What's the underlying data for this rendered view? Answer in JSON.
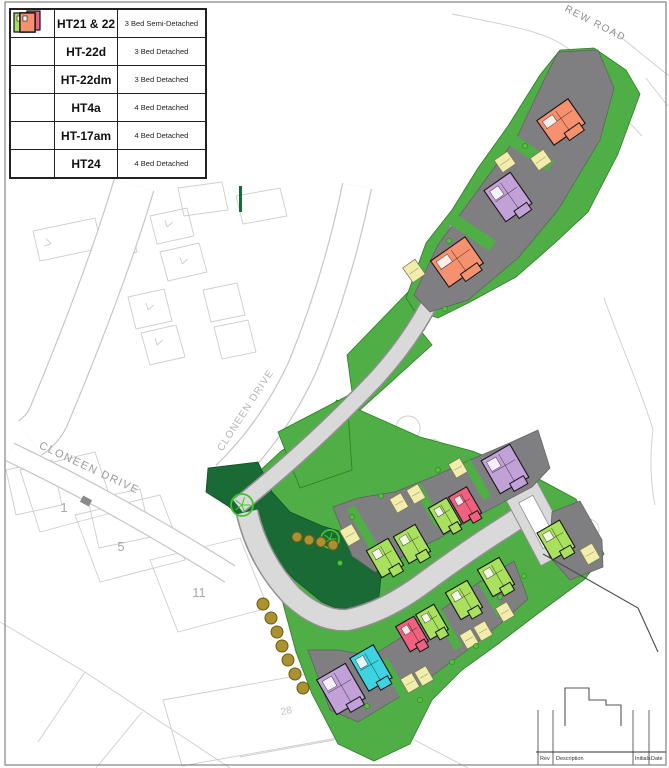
{
  "legend": {
    "rows": [
      {
        "colors": [
          "green",
          "pink"
        ],
        "name": "HT21 & 22",
        "desc": "3 Bed Semi-Detached"
      },
      {
        "colors": [
          "green"
        ],
        "name": "HT-22d",
        "desc": "3 Bed Detached"
      },
      {
        "colors": [
          "green"
        ],
        "name": "HT-22dm",
        "desc": "3 Bed Detached"
      },
      {
        "colors": [
          "cyan"
        ],
        "name": "HT4a",
        "desc": "4 Bed Detached"
      },
      {
        "colors": [
          "purple"
        ],
        "name": "HT-17am",
        "desc": "4 Bed Detached"
      },
      {
        "colors": [
          "orange"
        ],
        "name": "HT24",
        "desc": "4 Bed Detached"
      }
    ]
  },
  "map": {
    "palette": {
      "parcel": "#4fae45",
      "dark": "#1a6a36",
      "road": "#d9d9d9",
      "roadCase": "#8f8f8f",
      "whiteCase": "#c6c6c6",
      "drive": "#7f7f81",
      "garage": "#f2edaa",
      "faint": "#cdcdcd",
      "bush": "#ab9230",
      "tree": "#3fc52f",
      "green": "#a9e15e",
      "pink": "#f0617f",
      "purple": "#c2a0d8",
      "cyan": "#3dd3e1",
      "orange": "#f5916e"
    },
    "faint": {
      "quads": [
        "178,188 222,182 228,210 184,216",
        "150,216 187,208 194,236 157,244",
        "160,252 199,243 207,272 168,281",
        "128,297 164,289 172,321 136,329",
        "141,333 176,325 185,357 150,365",
        "103,233 131,227 137,252 109,258",
        "33,231 95,218 102,248 40,261",
        "236,196 280,188 287,216 243,224",
        "203,290 237,283 245,315 211,322",
        "214,327 248,320 256,352 222,359",
        "6,470 52,460 62,505 16,515",
        "88,500 140,489 151,537 99,548",
        "20,470 95,452 115,512 40,532",
        "75,515 160,495 185,560 100,582",
        "150,560 240,538 268,608 178,632",
        "163,700 318,672 338,738 182,766",
        "375,327 413,318 420,352 382,361"
      ],
      "lines": [
        "M0,622 L85,672 L230,768",
        "M85,672 L38,742",
        "M142,712 L96,768",
        "M240,757 L334,740",
        "M338,700 L468,768",
        "M604,298 C622,348 641,390 653,430",
        "M653,430 Q648,470 655,505",
        "M598,90 L642,136",
        "M646,78 Q659,95 668,106",
        "M452,14 C512,26 548,32 570,50 C586,64 596,84 604,106 L612,132",
        "M612,30 L669,76"
      ],
      "chevrons": [
        [
          168,
          224,
          15
        ],
        [
          183,
          261,
          15
        ],
        [
          149,
          307,
          15
        ],
        [
          158,
          342,
          15
        ],
        [
          48,
          243,
          -75
        ]
      ],
      "circles": [
        [
          425,
          556,
          14
        ],
        [
          451,
          534,
          11
        ],
        [
          408,
          428,
          12
        ],
        [
          588,
          530,
          11
        ],
        [
          432,
          448,
          9
        ]
      ]
    },
    "whiteRoads": [
      {
        "d": "M134,185 C114,252 84,332 48,418 Q42,430 30,438",
        "w": 40
      },
      {
        "d": "M10,452 Q115,502 230,574",
        "w": 18
      },
      {
        "d": "M357,186 Q338,280 302,368 Q272,432 226,476",
        "w": 28
      }
    ],
    "greens": [
      "337,400 420,437 472,451 524,471 576,499 604,554 585,579 540,612 498,644 462,670 432,700 410,744 374,761 338,744 312,694 296,652 282,600 258,545 238,505 250,480 280,452 310,430",
      "278,432 347,396 352,470 300,488",
      "347,355 412,288 420,330 352,392",
      "345,398 420,330 432,345 360,410",
      "406,298 426,243 452,210 478,168 508,126 540,75 560,50 594,48 626,70 640,94 618,154 588,212 556,242 516,277 470,302 438,318 414,310"
    ],
    "darkGreen": "208,468 258,462 272,492 290,512 322,526 356,536 384,547 378,606 352,615 322,602 295,580 268,552 247,522 228,506 206,492",
    "darkSliver": [
      239,
      186,
      3,
      26
    ],
    "greyRoads": [
      {
        "d": "M247,512 Q258,560 292,596 Q320,622 348,620 Q385,612 425,582 Q470,549 505,527 L526,513",
        "w": 20
      },
      {
        "d": "M238,506 Q310,448 370,385 Q420,333 445,270 Q455,240 460,220",
        "w": 15
      }
    ],
    "hammerhead": {
      "outer": [
        538,
        522,
        36,
        80,
        -28
      ],
      "island": [
        538,
        522,
        16,
        52,
        -28
      ]
    },
    "drives": [
      "558,52 598,50 614,88 600,140 558,210 518,258 468,300 430,312 414,295 438,245 478,190 518,135 543,82",
      "333,507 352,556 375,572 415,550 440,538 470,520 500,504 532,487 550,468 538,430 505,445 470,460 430,478 395,492 358,498",
      "308,650 330,710 358,722 396,699 432,676 466,651 500,624 528,599 514,561 478,583 444,608 408,633 372,656 338,650",
      "552,512 580,501 602,540 603,567 570,580 549,556"
    ],
    "gaps": [
      [
        362,
        527,
        9,
        46,
        -30
      ],
      [
        428,
        505,
        9,
        46,
        -30
      ],
      [
        477,
        480,
        9,
        42,
        -30
      ],
      [
        394,
        678,
        9,
        42,
        -30
      ],
      [
        448,
        630,
        9,
        42,
        -30
      ],
      [
        492,
        598,
        9,
        38,
        -30
      ],
      [
        530,
        152,
        50,
        12,
        34
      ],
      [
        472,
        232,
        50,
        12,
        34
      ]
    ],
    "junctionPad": [
      86,
      501,
      10,
      7,
      28
    ],
    "garages": [
      [
        505,
        162,
        16,
        15,
        -35
      ],
      [
        541,
        160,
        16,
        15,
        -35
      ],
      [
        414,
        271,
        15,
        18,
        -35
      ],
      [
        350,
        535,
        14,
        18,
        -30
      ],
      [
        399,
        503,
        13,
        16,
        -30
      ],
      [
        416,
        494,
        13,
        16,
        -30
      ],
      [
        458,
        468,
        13,
        16,
        -30
      ],
      [
        590,
        554,
        14,
        17,
        -30
      ],
      [
        410,
        683,
        13,
        16,
        -30
      ],
      [
        424,
        676,
        13,
        16,
        -30
      ],
      [
        469,
        639,
        13,
        16,
        -30
      ],
      [
        483,
        631,
        13,
        16,
        -30
      ],
      [
        505,
        612,
        13,
        16,
        -30
      ]
    ],
    "houses": [
      {
        "t": "HT24",
        "c": "orange",
        "x": 561,
        "y": 122,
        "w": 38,
        "h": 30,
        "r": -35
      },
      {
        "t": "HT-17am",
        "c": "purple",
        "x": 508,
        "y": 197,
        "w": 32,
        "h": 38,
        "r": -35
      },
      {
        "t": "HT24",
        "c": "orange",
        "x": 457,
        "y": 262,
        "w": 42,
        "h": 32,
        "r": -35
      },
      {
        "t": "HT-22d",
        "c": "green",
        "x": 385,
        "y": 558,
        "w": 25,
        "h": 31,
        "r": -30
      },
      {
        "t": "HT-22d",
        "c": "green",
        "x": 412,
        "y": 544,
        "w": 25,
        "h": 31,
        "r": -30
      },
      {
        "t": "HT21 & 22",
        "c": "green",
        "x": 445,
        "y": 516,
        "w": 21,
        "h": 30,
        "r": -30
      },
      {
        "t": "HT21 & 22",
        "c": "pink",
        "x": 465,
        "y": 505,
        "w": 21,
        "h": 30,
        "r": -30
      },
      {
        "t": "HT-17am",
        "c": "purple",
        "x": 505,
        "y": 469,
        "w": 33,
        "h": 38,
        "r": -30
      },
      {
        "t": "HT-22d",
        "c": "green",
        "x": 556,
        "y": 540,
        "w": 26,
        "h": 31,
        "r": -30
      },
      {
        "t": "HT-17am",
        "c": "purple",
        "x": 341,
        "y": 689,
        "w": 33,
        "h": 40,
        "r": -30
      },
      {
        "t": "HT4a",
        "c": "cyan",
        "x": 371,
        "y": 668,
        "w": 27,
        "h": 38,
        "r": -30
      },
      {
        "t": "HT21 & 22",
        "c": "pink",
        "x": 412,
        "y": 634,
        "w": 21,
        "h": 29,
        "r": -30
      },
      {
        "t": "HT21 & 22",
        "c": "green",
        "x": 432,
        "y": 622,
        "w": 21,
        "h": 29,
        "r": -30
      },
      {
        "t": "HT-22dm",
        "c": "green",
        "x": 464,
        "y": 600,
        "w": 25,
        "h": 31,
        "r": -30
      },
      {
        "t": "HT-22dm",
        "c": "green",
        "x": 496,
        "y": 577,
        "w": 25,
        "h": 31,
        "r": -30
      }
    ],
    "trees": [
      [
        242,
        505,
        11
      ],
      [
        330,
        539,
        9
      ]
    ],
    "bushes": [
      [
        297,
        537,
        5
      ],
      [
        309,
        540,
        5
      ],
      [
        321,
        542,
        5
      ],
      [
        333,
        545,
        5
      ],
      [
        263,
        604,
        6
      ],
      [
        271,
        618,
        6
      ],
      [
        277,
        632,
        6
      ],
      [
        282,
        646,
        6
      ],
      [
        288,
        660,
        6
      ],
      [
        295,
        674,
        6
      ],
      [
        303,
        688,
        6
      ]
    ],
    "shrubs": [
      [
        352,
        517
      ],
      [
        381,
        496
      ],
      [
        438,
        470
      ],
      [
        340,
        563
      ],
      [
        367,
        706
      ],
      [
        420,
        700
      ],
      [
        452,
        662
      ],
      [
        476,
        646
      ],
      [
        500,
        597
      ],
      [
        524,
        576
      ],
      [
        445,
        309
      ],
      [
        525,
        146
      ],
      [
        449,
        241
      ]
    ],
    "boundaries": [
      "M543,554 L638,608",
      "M638,608 L658,652"
    ],
    "labels": [
      {
        "text": "CLONEEN DRIVE",
        "x": 88,
        "y": 471,
        "r": 25,
        "s": 11,
        "sp": 1.5,
        "c": "#9b9b9b"
      },
      {
        "text": "CLONEEN DRIVE",
        "x": 248,
        "y": 412,
        "r": -57,
        "s": 10,
        "sp": 1,
        "c": "#b4b4b4"
      },
      {
        "text": "REW ROAD",
        "x": 594,
        "y": 26,
        "r": 27,
        "s": 10,
        "sp": 1.5,
        "c": "#8f8f8f"
      },
      {
        "text": "1",
        "x": 64,
        "y": 512,
        "r": 0,
        "s": 13,
        "sp": 0,
        "c": "#a8a8a8"
      },
      {
        "text": "5",
        "x": 121,
        "y": 551,
        "r": 0,
        "s": 13,
        "sp": 0,
        "c": "#a8a8a8"
      },
      {
        "text": "11",
        "x": 199,
        "y": 597,
        "r": 0,
        "s": 13,
        "sp": 0,
        "c": "#a8a8a8"
      },
      {
        "text": "28",
        "x": 287,
        "y": 714,
        "r": -12,
        "s": 10,
        "sp": 0,
        "c": "#bdbdbd"
      }
    ],
    "titleBlock": {
      "cells": [
        "Rev",
        "Description",
        "Initials",
        "Date"
      ],
      "cellX": [
        540,
        556,
        635,
        651
      ],
      "lineY": 752,
      "baseY": 760,
      "vlines": [
        [
          538,
          710
        ],
        [
          553,
          710
        ],
        [
          633,
          710
        ],
        [
          649,
          710
        ]
      ],
      "step": "M565,726 L565,688 L589,688 L589,700 L606,700 L606,705 L621,705 L621,726"
    },
    "frame": [
      5,
      2,
      661,
      763
    ]
  }
}
